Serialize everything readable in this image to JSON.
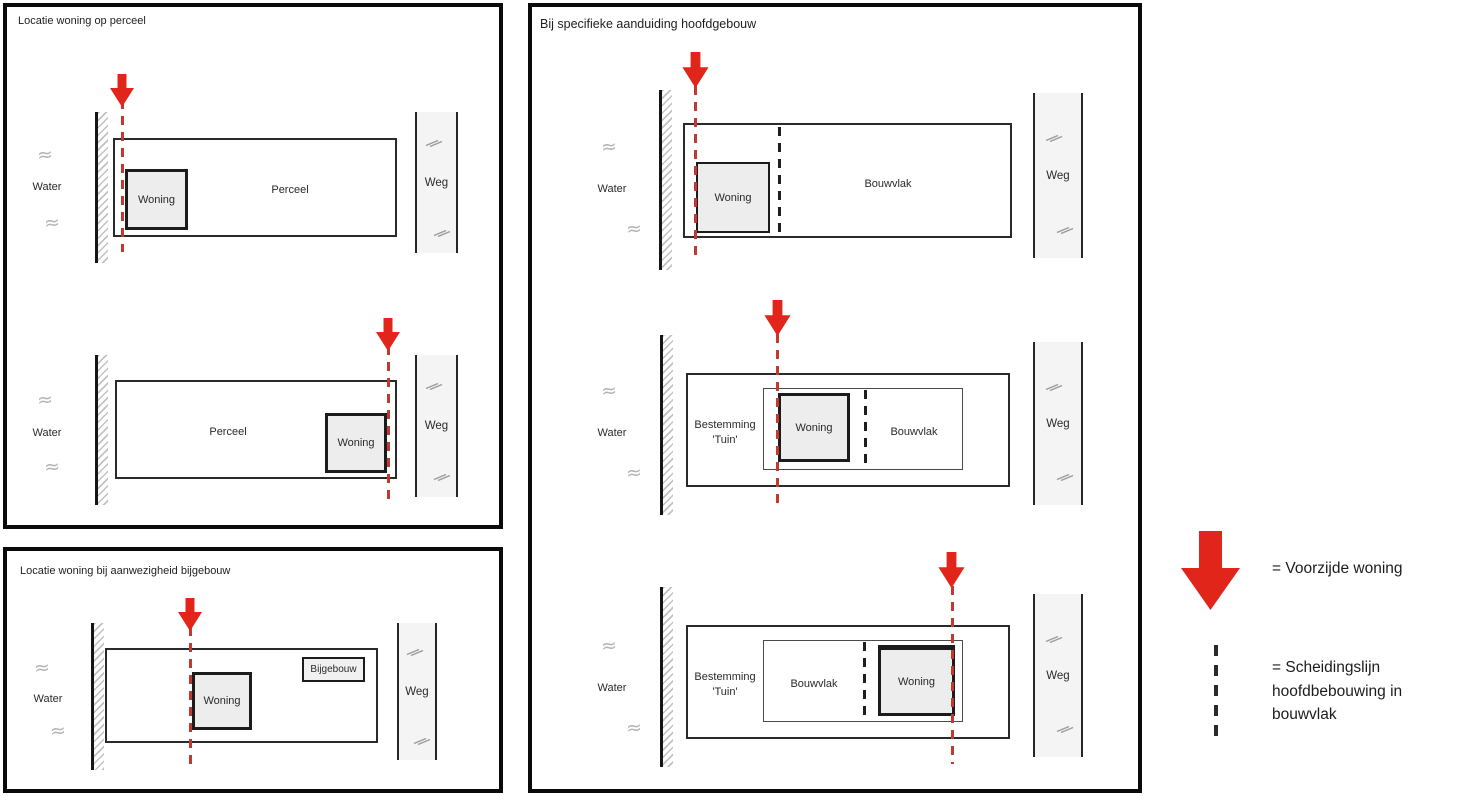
{
  "panel_locatie_perceel": {
    "title": "Locatie woning op perceel"
  },
  "panel_locatie_bijgebouw": {
    "title": "Locatie woning bij aanwezigheid bijgebouw"
  },
  "panel_specifieke_aanduiding": {
    "title": "Bij specifieke aanduiding hoofdgebouw"
  },
  "labels": {
    "water": "Water",
    "weg": "Weg",
    "woning": "Woning",
    "perceel": "Perceel",
    "bouwvlak": "Bouwvlak",
    "bijgebouw": "Bijgebouw",
    "bestemming": "Bestemming",
    "tuin": "'Tuin'",
    "wave": "≈"
  },
  "legend": {
    "voorzijde": "= Voorzijde woning",
    "scheidingslijn": [
      "= Scheidingslijn",
      "hoofdbebouwing in",
      "bouwvlak"
    ]
  },
  "colors": {
    "arrow_red": "#e2251b",
    "dash_red": "#c03a30",
    "line_black": "#1c1c1c",
    "building_fill": "#ededed",
    "road_fill": "#f4f4f4",
    "hatch_grey": "#c2c2c2",
    "text": "#2a2a2a"
  }
}
